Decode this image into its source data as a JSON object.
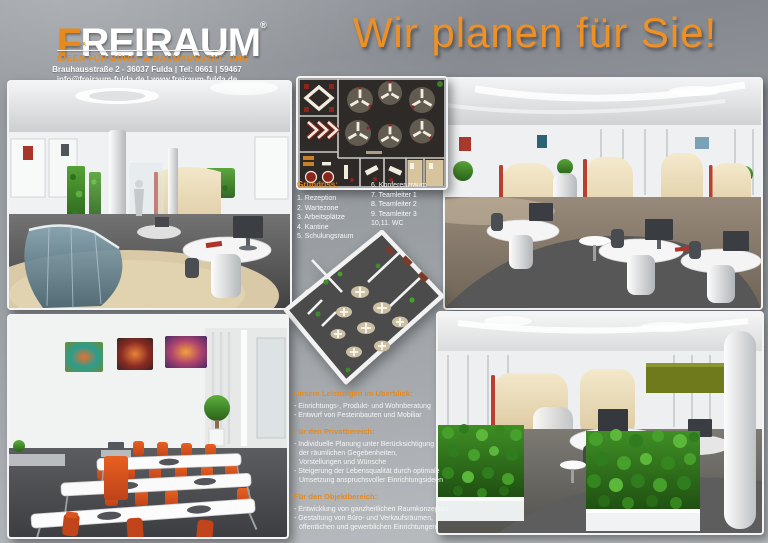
{
  "poster": {
    "brand": {
      "logo_first_letter": "F",
      "logo_rest": "REIRAUM",
      "registered_mark": "®",
      "logo_sub": "FULDA",
      "tagline": "IDEEN FÜR BÜRO- & RAUMAUSSTATTUNG",
      "address_line1": "Brauhausstraße 2 - 36037 Fulda  |  Tel: 0661 | 59467",
      "address_line2": "info@freiraum-fulda.de  |  www.freiraum-fulda.de"
    },
    "headline": "Wir planen für Sie!",
    "floorplan_legend": {
      "title": "Grundriss:",
      "column1": [
        "1. Rezeption",
        "2. Wartezone",
        "3. Arbeitsplätze",
        "4. Kantine",
        "5. Schulungsraum"
      ],
      "column2": [
        "6. Konferenzraum",
        "7. Teamleiter 1",
        "8. Teamleiter 2",
        "9. Teamleiter 3",
        "10,11. WC"
      ]
    },
    "services": {
      "overview_heading": "Unsere Leistungen im Überblick:",
      "overview_lines": [
        "- Einrichtungs-, Produkt- und Wohnberatung",
        "- Entwurf von Festeinbauten und Mobiliar"
      ],
      "private_heading": "Für den Privatbereich:",
      "private_lines": [
        "- Individuelle Planung unter Berücksichtigung",
        "der räumlichen Gegebenheiten,",
        "Vorstellungen und Wünsche",
        "- Steigerung der Lebensqualität durch optimale",
        "Umsetzung anspruchsvoller Einrichtungsideen"
      ],
      "object_heading": "Für den Objektbereich:",
      "object_lines": [
        "- Entwicklung von ganzheitlichen Raumkonzepten",
        "- Gestaltung von Büro- und Verkaufsräumen,",
        "öffentlichen und gewerblichen Einrichtungen"
      ]
    },
    "colors": {
      "accent_orange": "#E8891B",
      "headline_orange": "#EF9025",
      "chair_orange": "#D9541F",
      "plant_green": "#3F8A28",
      "partition_cream": "#ECDFBD",
      "background_gray": "#989CA1",
      "plan_background": "#2D2A27",
      "text_white": "#FFFFFF"
    }
  }
}
